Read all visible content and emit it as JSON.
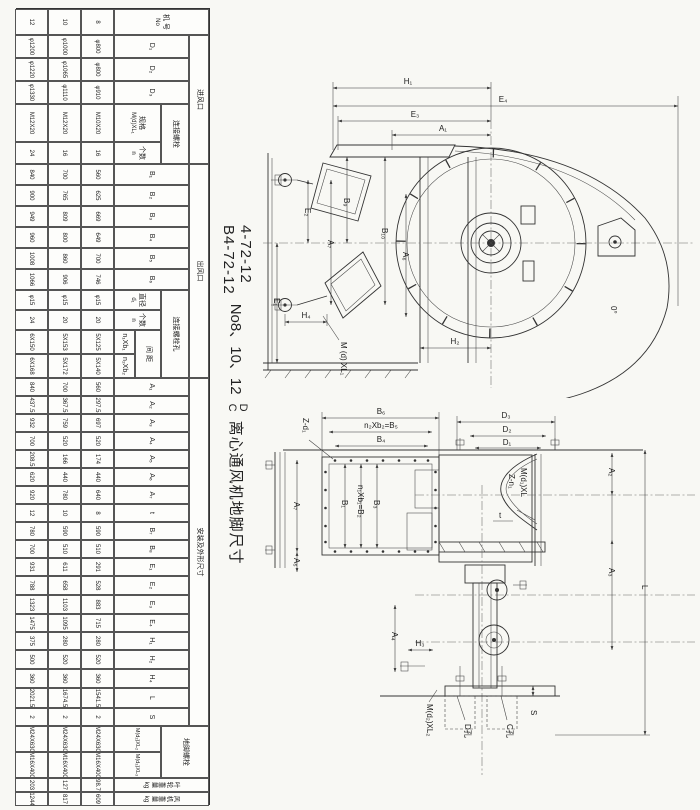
{
  "title": {
    "model1": "4-72-12",
    "model2": "B4-72-12",
    "range": "No8、10、12",
    "frac_top": "D",
    "frac_bottom": "C",
    "text": "离心通风机地脚尺寸"
  },
  "table": {
    "headers": {
      "jihao": "机 号",
      "no": "No",
      "jinfengkou": "进风口",
      "d1": "D₁",
      "d2": "D₂",
      "d3": "D₃",
      "lianjieluoshuan": "连接螺栓",
      "guige": "规格",
      "guige_spec": "M(d)XL₁",
      "geshu": "个数",
      "geshu_n": "n",
      "chufengkou": "出风口",
      "b1": "B₁",
      "b2": "B₂",
      "b3": "B₃",
      "b4": "B₄",
      "b5": "B₅",
      "b6": "B₆",
      "kong": "连接螺栓孔",
      "zhijing": "直径",
      "zhijing_d": "d₁",
      "geshu2": "个数",
      "geshu2_n": "n",
      "jianju": "间 距",
      "n1b1": "n₁Xb₁",
      "n2b2": "n₂Xb₂",
      "anzhuang": "安装及外形尺寸",
      "a1": "A₁",
      "a2": "A₂",
      "a3": "A₃",
      "a4": "A₄",
      "a5": "A₅",
      "a6": "A₆",
      "a7": "A₇",
      "t": "t",
      "b7": "B₇",
      "b8": "B₈",
      "e1": "E₁",
      "e2": "E₂",
      "e3": "E₃",
      "e4": "E₄",
      "h1": "H₁",
      "h2": "H₂",
      "h4": "H₄",
      "l": "L",
      "s": "S",
      "dijiao": "地脚螺栓",
      "dj1": "M(d₂)XL₂",
      "dj2": "M(d₃)XL₃",
      "yelun": "叶轮重量 kg",
      "fengji": "风机重量 kg"
    },
    "col_order": [
      "no",
      "D1",
      "D2",
      "D3",
      "spec",
      "n_in",
      "B1",
      "B2",
      "B3",
      "B4",
      "B5",
      "B6",
      "d1",
      "n_out",
      "n1b1",
      "n2b2",
      "A1",
      "A2",
      "A3",
      "A4",
      "A5",
      "A6",
      "A7",
      "t",
      "B7",
      "B8",
      "E1",
      "E2",
      "E3",
      "E4",
      "H1",
      "H2",
      "H4",
      "L",
      "S",
      "DJ1",
      "DJ2",
      "W1",
      "W2"
    ],
    "rows": [
      {
        "no": "8",
        "D1": "φ800",
        "D2": "φ800",
        "D3": "φ910",
        "spec": "M10X20",
        "n_in": "16",
        "B1": "560",
        "B2": "625",
        "B3": "669",
        "B4": "649",
        "B5": "700",
        "B6": "746",
        "d1": "φ15",
        "n_out": "20",
        "n1b1": "5X125",
        "n2b2": "5X140",
        "A1": "560",
        "A2": "297.5",
        "A3": "697",
        "A4": "520",
        "A5": "174",
        "A6": "440",
        "A7": "640",
        "t": "8",
        "B7": "590",
        "B8": "510",
        "E1": "291",
        "E2": "528",
        "E3": "883",
        "E4": "715",
        "H1": "280",
        "H2": "520",
        "H4": "360",
        "L": "1541.5",
        "S": "2",
        "DJ1": "M24X630",
        "DJ2": "M16X400",
        "W1": "98.7",
        "W2": "609"
      },
      {
        "no": "10",
        "D1": "φ1000",
        "D2": "φ1065",
        "D3": "φ1110",
        "spec": "M12X20",
        "n_in": "16",
        "B1": "700",
        "B2": "765",
        "B3": "809",
        "B4": "800",
        "B5": "860",
        "B6": "906",
        "d1": "φ15",
        "n_out": "20",
        "n1b1": "5X153",
        "n2b2": "5X172",
        "A1": "700",
        "A2": "367.5",
        "A3": "759",
        "A4": "520",
        "A5": "166",
        "A6": "440",
        "A7": "780",
        "t": "10",
        "B7": "590",
        "B8": "510",
        "E1": "611",
        "E2": "658",
        "E3": "1103",
        "E4": "1095",
        "H1": "280",
        "H2": "520",
        "H4": "360",
        "L": "1674.5",
        "S": "2",
        "DJ1": "M24X630",
        "DJ2": "M16X400",
        "W1": "127",
        "W2": "817"
      },
      {
        "no": "12",
        "D1": "φ1200",
        "D2": "φ1220",
        "D3": "φ1330",
        "spec": "M12X20",
        "n_in": "24",
        "B1": "840",
        "B2": "900",
        "B3": "949",
        "B4": "960",
        "B5": "1008",
        "B6": "1066",
        "d1": "φ15",
        "n_out": "24",
        "n1b1": "6X150",
        "n2b2": "6X168",
        "A1": "840",
        "A2": "437.5",
        "A3": "932",
        "A4": "700",
        "A5": "208.5",
        "A6": "620",
        "A7": "920",
        "t": "12",
        "B7": "780",
        "B8": "700",
        "E1": "931",
        "E2": "788",
        "E3": "1323",
        "E4": "1475",
        "H1": "375",
        "H2": "500",
        "H4": "360",
        "L": "2021.5",
        "S": "2",
        "DJ1": "M24X630",
        "DJ2": "M16X400",
        "W1": "203",
        "W2": "1244"
      }
    ]
  },
  "top_view": {
    "dim_h1": "H₁",
    "dim_e4": "E₄",
    "dim_e3": "E₃",
    "dim_a1": "A₁",
    "dim_e2": "E₂",
    "dim_a7": "A₇",
    "dim_e1": "E₁",
    "dim_b9": "B₉",
    "dim_b10": "B₁₀",
    "dim_a6": "A₆",
    "dim_h4": "H₄",
    "dim_h2": "H₂",
    "bolt_note": "M (d) XL₁",
    "angle_note": "0°"
  },
  "side_view": {
    "dim_b6": "B₆",
    "dim_b5eq": "n₂Xb₂=B₅",
    "dim_b4": "B₄",
    "hole_note": "Z-d₁",
    "dim_a7": "A₇",
    "dim_a5": "A₅",
    "dim_b1": "B₁",
    "dim_b2eq": "n₁Xb₁=B₂",
    "dim_b3": "B₃",
    "dim_d3": "D₃",
    "dim_d2": "D₂",
    "dim_d1": "D₁",
    "inlet_note1": "M(d₁)XL",
    "inlet_note2": "Z-n₁",
    "dim_a2": "A₂",
    "dim_a3": "A₃",
    "dim_l": "L",
    "dim_t": "t",
    "dim_a4": "A₄",
    "dim_h3": "H₃",
    "dim_s": "S",
    "anchor_note": "M(d₂)XL₂",
    "leader1": "D孔",
    "leader2": "C孔"
  }
}
